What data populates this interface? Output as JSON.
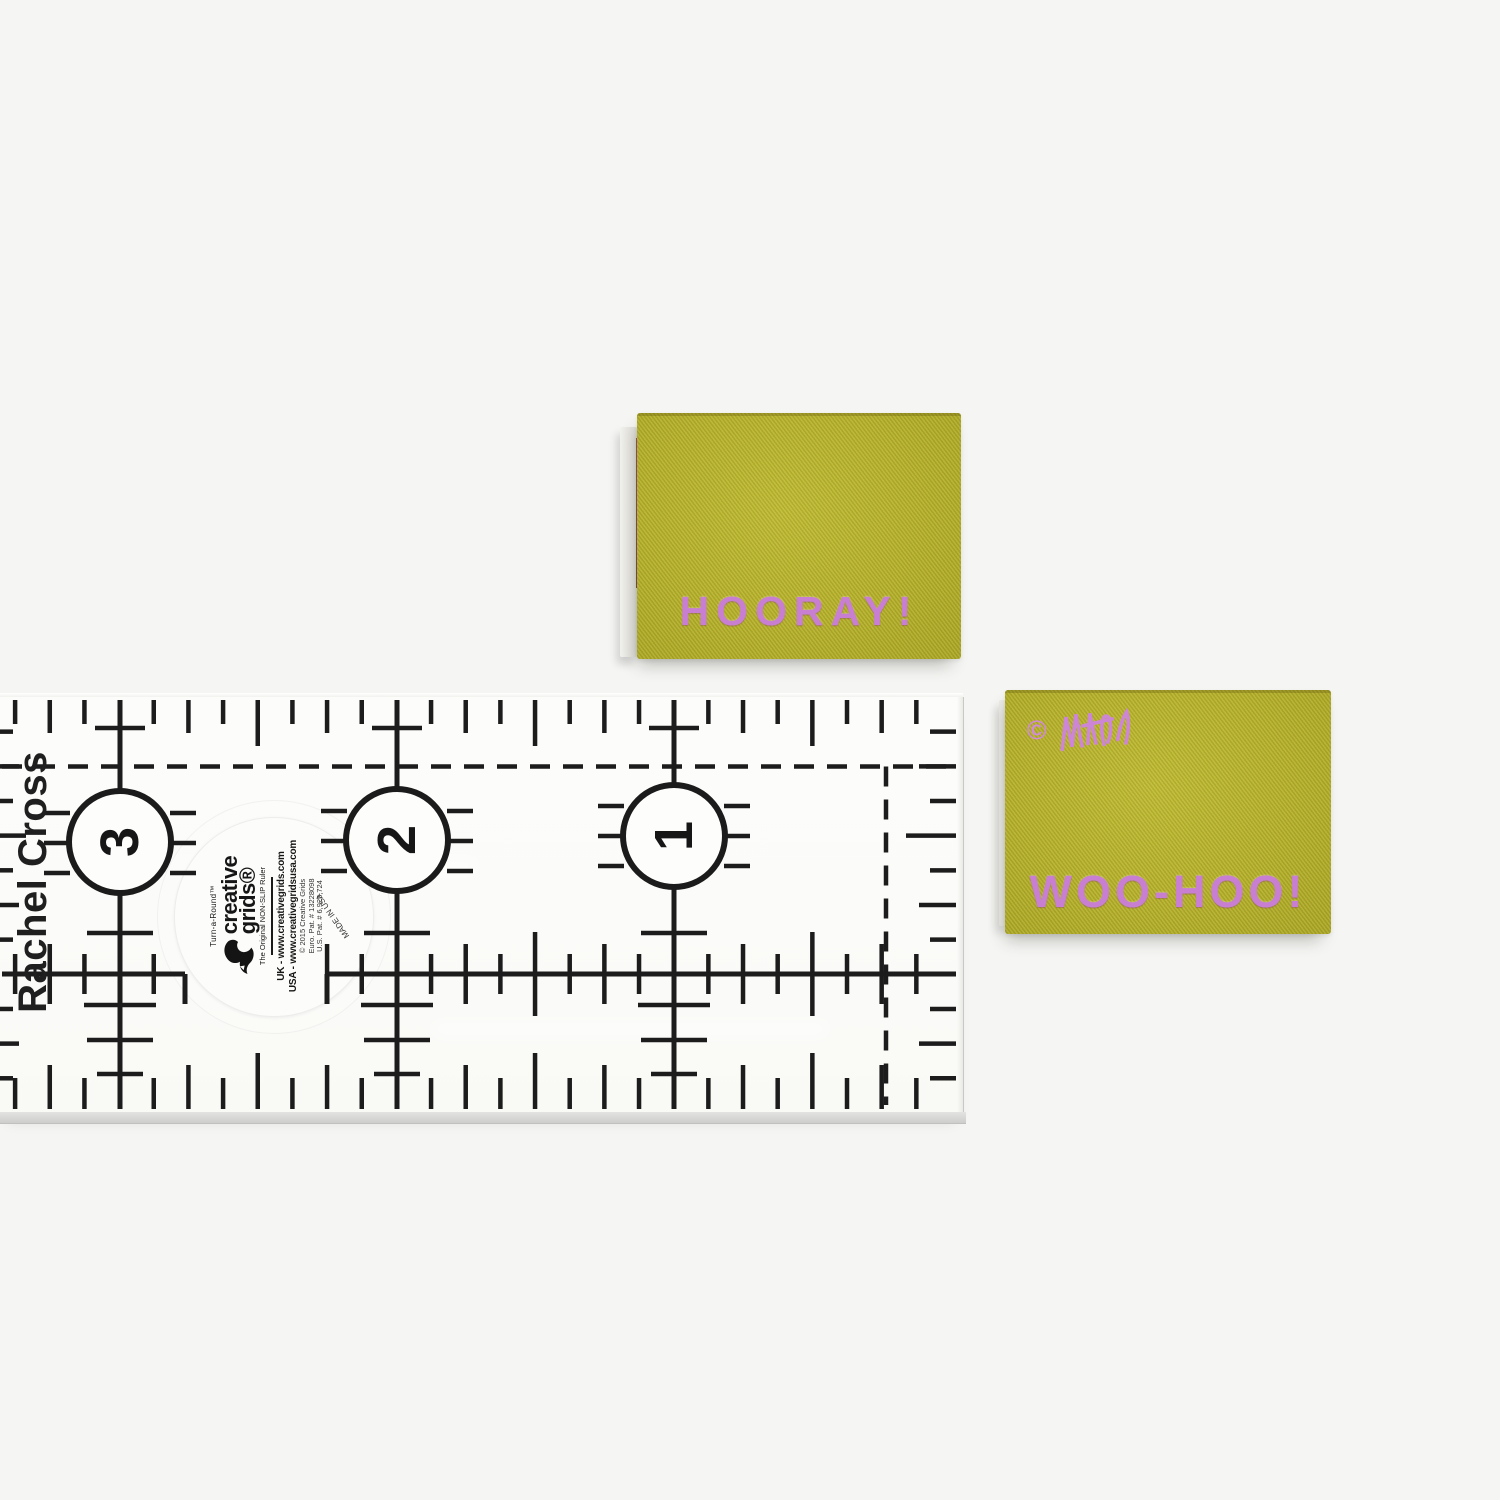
{
  "colors": {
    "background": "#f5f5f3",
    "ruler_ink": "#1c1c1c",
    "label_green": "#b2ad2b",
    "label_text_pink": "#c87fd2"
  },
  "ruler": {
    "watermark": "Rachel Cross",
    "numbers": [
      "3",
      "2",
      "1"
    ],
    "sticker": {
      "series": "Turn-a-Round™",
      "brand1": "creative",
      "brand2": "grids®",
      "tagline": "The Original NON-SLIP Ruler",
      "uk": "UK - www.creativegrids.com",
      "usa": "USA - www.creativegridsusa.com",
      "copyright": "© 2015 Creative Grids",
      "euro_patent": "Euro. Pat. # 13228098",
      "us_patent": "U.S. Pat. # 6,925,724",
      "made_in": "MADE IN USA"
    }
  },
  "labels": {
    "hooray": {
      "text": "HOORAY!"
    },
    "woohoo": {
      "text": "WOO-HOO!",
      "copyright": "©"
    }
  },
  "icons": {
    "brand_logo": "squirrel-icon",
    "maker_mark": "signature-scribble-icon"
  }
}
